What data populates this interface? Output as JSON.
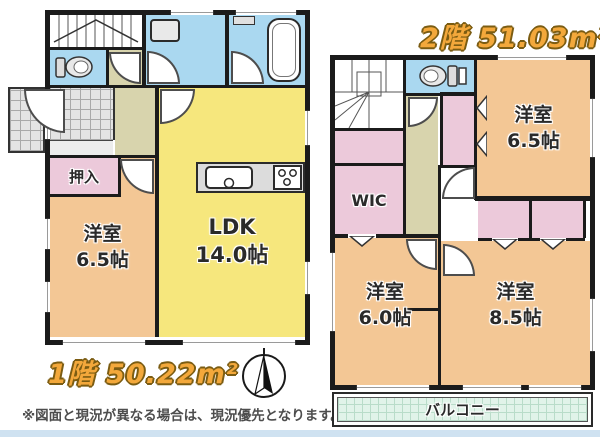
{
  "colors": {
    "wall": "#1b1b1b",
    "room_peach": "#f3c795",
    "room_yellow": "#f6e77d",
    "closet_pink": "#ecc9da",
    "wet_area_blue": "#aad8f0",
    "hall_beige": "#d8d4ad",
    "balcony_mint": "#e1f3e9",
    "title_gold": "#f3a83b",
    "label_ink": "#2a2a2a",
    "bottom_strip": "#cfe2f1"
  },
  "icons": [
    "toilet-icon",
    "washing-machine-icon",
    "bathtub-icon",
    "kitchen-sink-icon",
    "stove-icon",
    "compass-icon",
    "door-arc",
    "door-chevron"
  ],
  "floor1": {
    "title": "1階 50.22m²",
    "rooms": {
      "oshiire": "押入",
      "yoshitsu": {
        "line1": "洋室",
        "line2": "6.5帖"
      },
      "ldk": {
        "line1": "LDK",
        "line2": "14.0帖"
      }
    }
  },
  "floor2": {
    "title": "2階 51.03m²",
    "rooms": {
      "wic": "WIC",
      "yoshitsu_65": {
        "line1": "洋室",
        "line2": "6.5帖"
      },
      "yoshitsu_60": {
        "line1": "洋室",
        "line2": "6.0帖"
      },
      "yoshitsu_85": {
        "line1": "洋室",
        "line2": "8.5帖"
      },
      "balcony": "バルコニー"
    }
  },
  "footer": {
    "disclaimer": "※図面と現況が異なる場合は、現況優先となります。"
  }
}
